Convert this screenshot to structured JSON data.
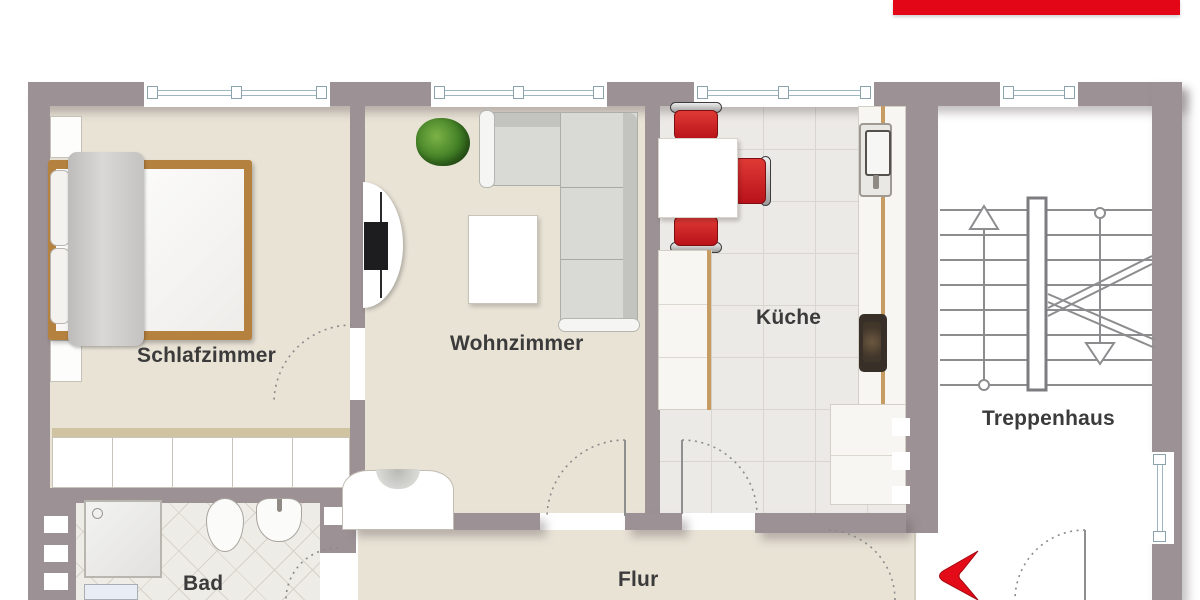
{
  "document": {
    "type": "apartment-floor-plan",
    "language": "de"
  },
  "branding": {
    "top_bar_color": "#e30617"
  },
  "rooms": [
    {
      "id": "schlafzimmer",
      "label": "Schlafzimmer"
    },
    {
      "id": "wohnzimmer",
      "label": "Wohnzimmer"
    },
    {
      "id": "kueche",
      "label": "Küche"
    },
    {
      "id": "treppenhaus",
      "label": "Treppenhaus"
    },
    {
      "id": "flur",
      "label": "Flur"
    },
    {
      "id": "bad",
      "label": "Bad"
    }
  ],
  "markers": {
    "entrance_arrow": "red-chevron-left",
    "stair_direction_up": "arrow-up",
    "stair_direction_down": "arrow-down"
  },
  "colors": {
    "wall": "#9c9194",
    "floor": "#e9e3d6",
    "kitchen_tile": "#eceae6",
    "bath_tile": "#eeece7",
    "stairwell": "#ffffff",
    "accent_red": "#e30617",
    "bed_wood": "#b5813e",
    "chair_red": "#c1151b"
  }
}
